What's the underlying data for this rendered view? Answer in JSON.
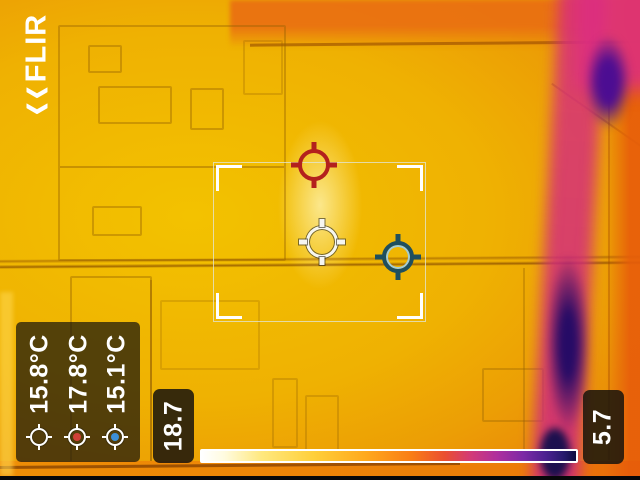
{
  "brand": "FLIR",
  "scene": {
    "description": "thermal image of interior doors in iron palette, cold purple streak along right side"
  },
  "overlay": {
    "spot_readings": [
      {
        "label": "15.8°C",
        "marker": "white-spot-marker",
        "marker_color": "#f6f6f0"
      },
      {
        "label": "17.8°C",
        "marker": "red-spot-marker",
        "marker_color": "#c8413a"
      },
      {
        "label": "15.1°C",
        "marker": "blue-spot-marker",
        "marker_color": "#3d8fd6"
      }
    ],
    "spot_markers_on_image": [
      {
        "name": "red-crosshair",
        "color": "#b3211d"
      },
      {
        "name": "white-crosshair",
        "color": "#f6f6f0"
      },
      {
        "name": "blue-crosshair",
        "color": "#1f4f5e"
      }
    ],
    "scale": {
      "max_label": "18.7",
      "min_label": "5.7",
      "palette": "iron-reversed-hot-left",
      "hot_color": "#ffffff",
      "cold_color": "#0e0c3e"
    }
  }
}
